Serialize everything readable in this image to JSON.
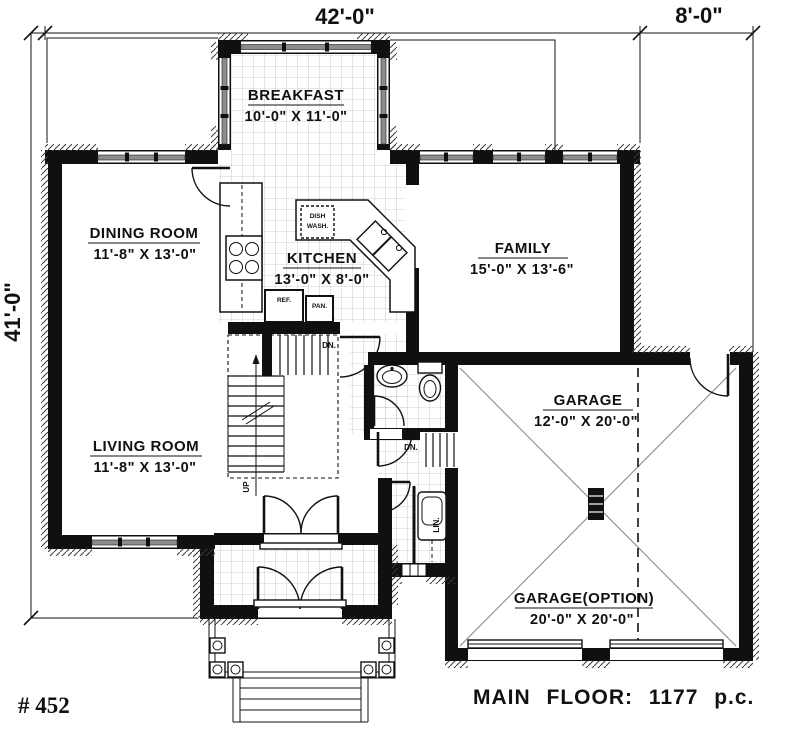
{
  "drawing": {
    "plan_number": "# 452",
    "floor_title": "MAIN FLOOR: 1177 p.c."
  },
  "dimensions": {
    "top_width": "42'-0\"",
    "top_right_width": "8'-0\"",
    "left_height": "41'-0\""
  },
  "rooms": {
    "breakfast": {
      "name": "BREAKFAST",
      "size": "10'-0\" X 11'-0\""
    },
    "dining": {
      "name": "DINING ROOM",
      "size": "11'-8\" X 13'-0\""
    },
    "kitchen": {
      "name": "KITCHEN",
      "size": "13'-0\" X 8'-0\""
    },
    "family": {
      "name": "FAMILY",
      "size": "15'-0\" X 13'-6\""
    },
    "living": {
      "name": "LIVING ROOM",
      "size": "11'-8\" X 13'-0\""
    },
    "garage": {
      "name": "GARAGE",
      "size": "12'-0\" X 20'-0\""
    },
    "garage_option": {
      "name": "GARAGE(OPTION)",
      "size": "20'-0\" X 20'-0\""
    }
  },
  "annotations": {
    "stairs_up": "UP",
    "stairs_down_basement": "DN.",
    "stairs_down_garage": "DN.",
    "refrigerator": "REF.",
    "pantry": "PAN.",
    "dishwasher_line1": "DISH",
    "dishwasher_line2": "WASH.",
    "linen": "LIN."
  },
  "colors": {
    "wall": "#101010",
    "window": "#8c8c8c",
    "diagonal": "#8a8a8a"
  }
}
